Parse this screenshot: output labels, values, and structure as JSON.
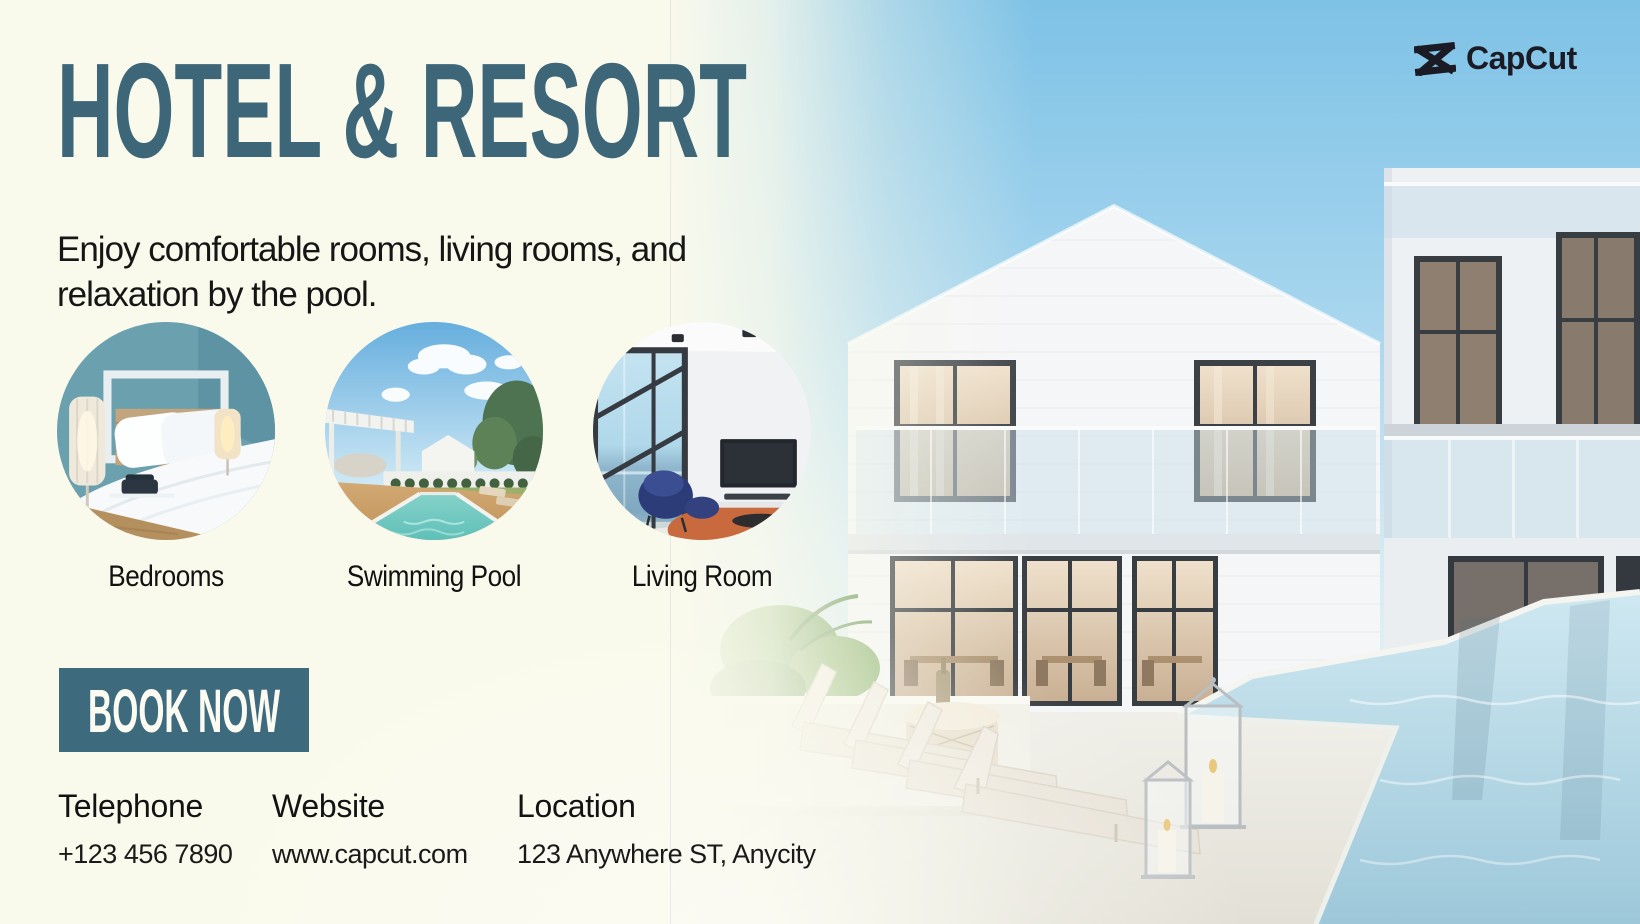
{
  "brand": {
    "name": "CapCut"
  },
  "hero": {
    "title": "HOTEL & RESORT",
    "subtitle": "Enjoy comfortable rooms, living rooms, and relaxation by the pool."
  },
  "features": [
    {
      "label": "Bedrooms"
    },
    {
      "label": "Swimming Pool"
    },
    {
      "label": "Living Room"
    }
  ],
  "cta": {
    "label": "BOOK NOW"
  },
  "contact": [
    {
      "heading": "Telephone",
      "value": "+123 456 7890"
    },
    {
      "heading": "Website",
      "value": "www.capcut.com"
    },
    {
      "heading": "Location",
      "value": "123 Anywhere ST, Anycity"
    }
  ],
  "colors": {
    "title_teal": "#3d6678",
    "button_teal": "#3e6a7e",
    "background_cream": "#fafaec",
    "sky_blue": "#7ec2e6",
    "logo_dark": "#1b1b26",
    "text_dark": "#141414"
  }
}
